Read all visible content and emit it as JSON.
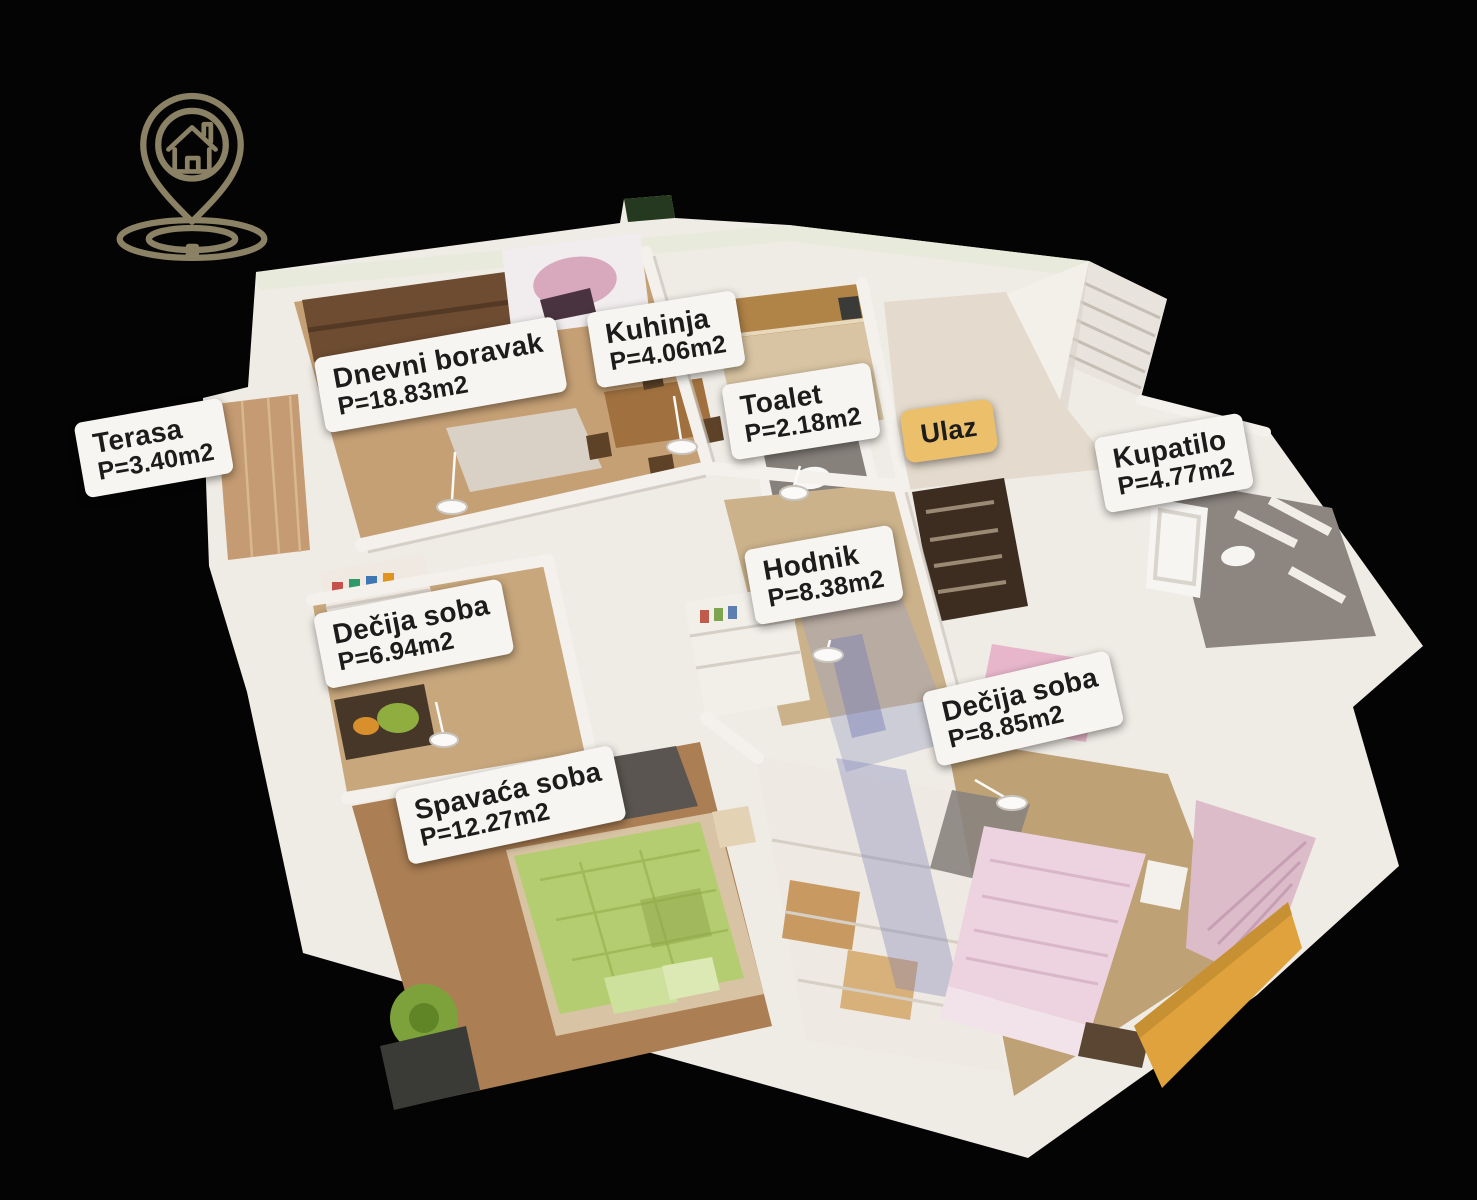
{
  "theme": {
    "background": "#040404",
    "label-bg": "#f7f5f1",
    "label-text": "#1c1c1c",
    "ulaz-bg": "#ecbf6a",
    "logo-color": "#8b8164"
  },
  "logo": {
    "icon": "house-location-pin-icon"
  },
  "floorplan": {
    "rooms": [
      {
        "id": "terasa",
        "label": "Terasa",
        "area": "P=3.40m2"
      },
      {
        "id": "dnevni-boravak",
        "label": "Dnevni boravak",
        "area": "P=18.83m2"
      },
      {
        "id": "kuhinja",
        "label": "Kuhinja",
        "area": "P=4.06m2"
      },
      {
        "id": "toalet",
        "label": "Toalet",
        "area": "P=2.18m2"
      },
      {
        "id": "ulaz",
        "label": "Ulaz"
      },
      {
        "id": "kupatilo",
        "label": "Kupatilo",
        "area": "P=4.77m2"
      },
      {
        "id": "hodnik",
        "label": "Hodnik",
        "area": "P=8.38m2"
      },
      {
        "id": "decija-soba-1",
        "label": "Dečija soba",
        "area": "P=6.94m2"
      },
      {
        "id": "decija-soba-2",
        "label": "Dečija soba",
        "area": "P=8.85m2"
      },
      {
        "id": "spavaca-soba",
        "label": "Spavaća soba",
        "area": "P=12.27m2"
      }
    ]
  }
}
